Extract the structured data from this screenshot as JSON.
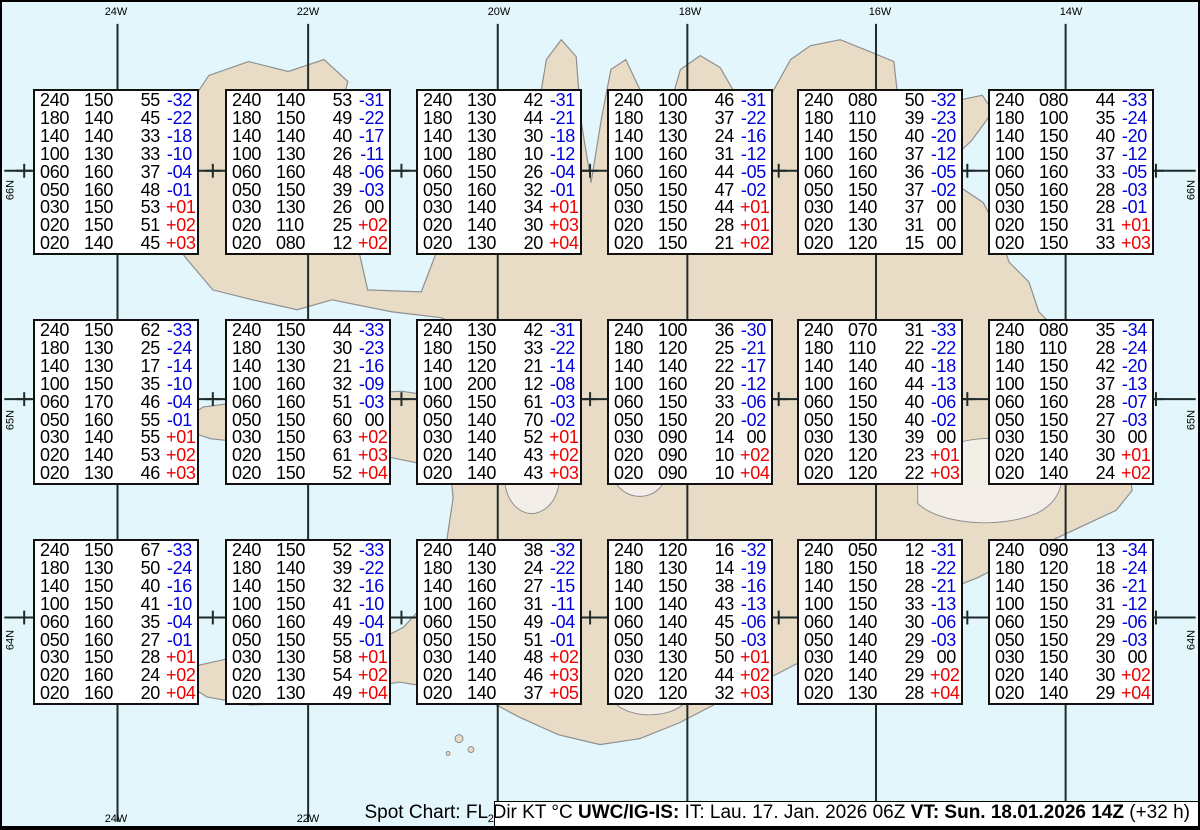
{
  "colors": {
    "sea": "#e2f6fb",
    "land": "#e9dcc6",
    "coast": "#8f8f8f",
    "grid": "#1f2a2a",
    "negative_temp": "#0000dd",
    "positive_temp": "#ee0000",
    "zero_temp": "#000000",
    "box_bg": "#ffffff",
    "box_border": "#111111"
  },
  "map": {
    "meridians": [
      {
        "label": "24W",
        "x": 114
      },
      {
        "label": "22W",
        "x": 306
      },
      {
        "label": "20W",
        "x": 497
      },
      {
        "label": "18W",
        "x": 688
      },
      {
        "label": "16W",
        "x": 878
      },
      {
        "label": "14W",
        "x": 1069
      }
    ],
    "parallels": [
      {
        "label": "66N",
        "y": 170
      },
      {
        "label": "65N",
        "y": 400
      },
      {
        "label": "64N",
        "y": 620
      }
    ],
    "cross_xs": [
      20,
      210,
      400,
      590,
      780,
      970,
      1160
    ]
  },
  "legend": {
    "segments": [
      {
        "text": "Spot Chart: FL Dir KT °C ",
        "bold": false
      },
      {
        "text": "UWC/IG-IS:",
        "bold": true
      },
      {
        "text": " IT: Lau. 17. Jan. 2026 06Z ",
        "bold": false
      },
      {
        "text": "VT: Sun. 18.01.2026 14Z",
        "bold": true
      },
      {
        "text": " (+32 h)",
        "bold": false
      }
    ]
  },
  "chart_data": {
    "type": "table",
    "title": "Spot Chart: FL Dir KT °C",
    "columns": [
      "FL",
      "Dir",
      "KT",
      "°C"
    ],
    "producer": "UWC/IG-IS",
    "issued": "IT: Lau. 17. Jan. 2026 06Z",
    "valid": "VT: Sun. 18.01.2026 14Z",
    "forecast_offset": "(+32 h)",
    "grid_longitudes": [
      "24W",
      "22W",
      "20W",
      "18W",
      "16W",
      "14W"
    ],
    "grid_latitudes": [
      "66N",
      "65N",
      "64N"
    ],
    "spots": [
      {
        "lon": "24W",
        "lat": "66N",
        "rows": [
          [
            "240",
            "150",
            "55",
            "-32"
          ],
          [
            "180",
            "140",
            "45",
            "-22"
          ],
          [
            "140",
            "140",
            "33",
            "-18"
          ],
          [
            "100",
            "130",
            "33",
            "-10"
          ],
          [
            "060",
            "160",
            "37",
            "-04"
          ],
          [
            "050",
            "160",
            "48",
            "-01"
          ],
          [
            "030",
            "150",
            "53",
            "+01"
          ],
          [
            "020",
            "150",
            "51",
            "+02"
          ],
          [
            "020",
            "140",
            "45",
            "+03"
          ]
        ]
      },
      {
        "lon": "22W",
        "lat": "66N",
        "rows": [
          [
            "240",
            "140",
            "53",
            "-31"
          ],
          [
            "180",
            "150",
            "49",
            "-22"
          ],
          [
            "140",
            "140",
            "40",
            "-17"
          ],
          [
            "100",
            "130",
            "26",
            "-11"
          ],
          [
            "060",
            "160",
            "48",
            "-06"
          ],
          [
            "050",
            "150",
            "39",
            "-03"
          ],
          [
            "030",
            "130",
            "26",
            "00"
          ],
          [
            "020",
            "110",
            "25",
            "+02"
          ],
          [
            "020",
            "080",
            "12",
            "+02"
          ]
        ]
      },
      {
        "lon": "20W",
        "lat": "66N",
        "rows": [
          [
            "240",
            "130",
            "42",
            "-31"
          ],
          [
            "180",
            "130",
            "44",
            "-21"
          ],
          [
            "140",
            "130",
            "30",
            "-18"
          ],
          [
            "100",
            "180",
            "10",
            "-12"
          ],
          [
            "060",
            "150",
            "26",
            "-04"
          ],
          [
            "050",
            "160",
            "32",
            "-01"
          ],
          [
            "030",
            "140",
            "34",
            "+01"
          ],
          [
            "020",
            "140",
            "30",
            "+03"
          ],
          [
            "020",
            "130",
            "20",
            "+04"
          ]
        ]
      },
      {
        "lon": "18W",
        "lat": "66N",
        "rows": [
          [
            "240",
            "100",
            "46",
            "-31"
          ],
          [
            "180",
            "130",
            "37",
            "-22"
          ],
          [
            "140",
            "130",
            "24",
            "-16"
          ],
          [
            "100",
            "160",
            "31",
            "-12"
          ],
          [
            "060",
            "160",
            "44",
            "-05"
          ],
          [
            "050",
            "150",
            "47",
            "-02"
          ],
          [
            "030",
            "150",
            "44",
            "+01"
          ],
          [
            "020",
            "150",
            "28",
            "+01"
          ],
          [
            "020",
            "150",
            "21",
            "+02"
          ]
        ]
      },
      {
        "lon": "16W",
        "lat": "66N",
        "rows": [
          [
            "240",
            "080",
            "50",
            "-32"
          ],
          [
            "180",
            "110",
            "39",
            "-23"
          ],
          [
            "140",
            "150",
            "40",
            "-20"
          ],
          [
            "100",
            "160",
            "37",
            "-12"
          ],
          [
            "060",
            "160",
            "36",
            "-05"
          ],
          [
            "050",
            "150",
            "37",
            "-02"
          ],
          [
            "030",
            "140",
            "37",
            "00"
          ],
          [
            "020",
            "130",
            "31",
            "00"
          ],
          [
            "020",
            "120",
            "15",
            "00"
          ]
        ]
      },
      {
        "lon": "14W",
        "lat": "66N",
        "rows": [
          [
            "240",
            "080",
            "44",
            "-33"
          ],
          [
            "180",
            "100",
            "35",
            "-24"
          ],
          [
            "140",
            "150",
            "40",
            "-20"
          ],
          [
            "100",
            "150",
            "37",
            "-12"
          ],
          [
            "060",
            "160",
            "33",
            "-05"
          ],
          [
            "050",
            "160",
            "28",
            "-03"
          ],
          [
            "030",
            "150",
            "28",
            "-01"
          ],
          [
            "020",
            "150",
            "31",
            "+01"
          ],
          [
            "020",
            "150",
            "33",
            "+03"
          ]
        ]
      },
      {
        "lon": "24W",
        "lat": "65N",
        "rows": [
          [
            "240",
            "150",
            "62",
            "-33"
          ],
          [
            "180",
            "130",
            "25",
            "-24"
          ],
          [
            "140",
            "130",
            "17",
            "-14"
          ],
          [
            "100",
            "150",
            "35",
            "-10"
          ],
          [
            "060",
            "170",
            "46",
            "-04"
          ],
          [
            "050",
            "160",
            "55",
            "-01"
          ],
          [
            "030",
            "140",
            "55",
            "+01"
          ],
          [
            "020",
            "140",
            "53",
            "+02"
          ],
          [
            "020",
            "130",
            "46",
            "+03"
          ]
        ]
      },
      {
        "lon": "22W",
        "lat": "65N",
        "rows": [
          [
            "240",
            "150",
            "44",
            "-33"
          ],
          [
            "180",
            "130",
            "30",
            "-23"
          ],
          [
            "140",
            "130",
            "21",
            "-16"
          ],
          [
            "100",
            "160",
            "32",
            "-09"
          ],
          [
            "060",
            "160",
            "51",
            "-03"
          ],
          [
            "050",
            "150",
            "60",
            "00"
          ],
          [
            "030",
            "150",
            "63",
            "+02"
          ],
          [
            "020",
            "150",
            "61",
            "+03"
          ],
          [
            "020",
            "150",
            "52",
            "+04"
          ]
        ]
      },
      {
        "lon": "20W",
        "lat": "65N",
        "rows": [
          [
            "240",
            "130",
            "42",
            "-31"
          ],
          [
            "180",
            "150",
            "33",
            "-22"
          ],
          [
            "140",
            "120",
            "21",
            "-14"
          ],
          [
            "100",
            "200",
            "12",
            "-08"
          ],
          [
            "060",
            "150",
            "61",
            "-03"
          ],
          [
            "050",
            "140",
            "70",
            "-02"
          ],
          [
            "030",
            "140",
            "52",
            "+01"
          ],
          [
            "020",
            "140",
            "43",
            "+02"
          ],
          [
            "020",
            "140",
            "43",
            "+03"
          ]
        ]
      },
      {
        "lon": "18W",
        "lat": "65N",
        "rows": [
          [
            "240",
            "100",
            "36",
            "-30"
          ],
          [
            "180",
            "120",
            "25",
            "-21"
          ],
          [
            "140",
            "140",
            "22",
            "-17"
          ],
          [
            "100",
            "160",
            "20",
            "-12"
          ],
          [
            "060",
            "150",
            "33",
            "-06"
          ],
          [
            "050",
            "150",
            "20",
            "-02"
          ],
          [
            "030",
            "090",
            "14",
            "00"
          ],
          [
            "020",
            "090",
            "10",
            "+02"
          ],
          [
            "020",
            "090",
            "10",
            "+04"
          ]
        ]
      },
      {
        "lon": "16W",
        "lat": "65N",
        "rows": [
          [
            "240",
            "070",
            "31",
            "-33"
          ],
          [
            "180",
            "110",
            "22",
            "-22"
          ],
          [
            "140",
            "140",
            "40",
            "-18"
          ],
          [
            "100",
            "160",
            "44",
            "-13"
          ],
          [
            "060",
            "150",
            "40",
            "-06"
          ],
          [
            "050",
            "150",
            "40",
            "-02"
          ],
          [
            "030",
            "130",
            "39",
            "00"
          ],
          [
            "020",
            "120",
            "23",
            "+01"
          ],
          [
            "020",
            "120",
            "22",
            "+03"
          ]
        ]
      },
      {
        "lon": "14W",
        "lat": "65N",
        "rows": [
          [
            "240",
            "080",
            "35",
            "-34"
          ],
          [
            "180",
            "110",
            "28",
            "-24"
          ],
          [
            "140",
            "150",
            "42",
            "-20"
          ],
          [
            "100",
            "150",
            "37",
            "-13"
          ],
          [
            "060",
            "160",
            "28",
            "-07"
          ],
          [
            "050",
            "150",
            "27",
            "-03"
          ],
          [
            "030",
            "150",
            "30",
            "00"
          ],
          [
            "020",
            "140",
            "30",
            "+01"
          ],
          [
            "020",
            "140",
            "24",
            "+02"
          ]
        ]
      },
      {
        "lon": "24W",
        "lat": "64N",
        "rows": [
          [
            "240",
            "150",
            "67",
            "-33"
          ],
          [
            "180",
            "130",
            "50",
            "-24"
          ],
          [
            "140",
            "150",
            "40",
            "-16"
          ],
          [
            "100",
            "150",
            "41",
            "-10"
          ],
          [
            "060",
            "160",
            "35",
            "-04"
          ],
          [
            "050",
            "160",
            "27",
            "-01"
          ],
          [
            "030",
            "150",
            "28",
            "+01"
          ],
          [
            "020",
            "160",
            "24",
            "+02"
          ],
          [
            "020",
            "160",
            "20",
            "+04"
          ]
        ]
      },
      {
        "lon": "22W",
        "lat": "64N",
        "rows": [
          [
            "240",
            "150",
            "52",
            "-33"
          ],
          [
            "180",
            "140",
            "39",
            "-22"
          ],
          [
            "140",
            "150",
            "32",
            "-16"
          ],
          [
            "100",
            "150",
            "41",
            "-10"
          ],
          [
            "060",
            "160",
            "49",
            "-04"
          ],
          [
            "050",
            "150",
            "55",
            "-01"
          ],
          [
            "030",
            "130",
            "58",
            "+01"
          ],
          [
            "020",
            "130",
            "54",
            "+02"
          ],
          [
            "020",
            "130",
            "49",
            "+04"
          ]
        ]
      },
      {
        "lon": "20W",
        "lat": "64N",
        "rows": [
          [
            "240",
            "140",
            "38",
            "-32"
          ],
          [
            "180",
            "130",
            "24",
            "-22"
          ],
          [
            "140",
            "160",
            "27",
            "-15"
          ],
          [
            "100",
            "160",
            "31",
            "-11"
          ],
          [
            "060",
            "150",
            "49",
            "-04"
          ],
          [
            "050",
            "150",
            "51",
            "-01"
          ],
          [
            "030",
            "140",
            "48",
            "+02"
          ],
          [
            "020",
            "140",
            "46",
            "+03"
          ],
          [
            "020",
            "140",
            "37",
            "+05"
          ]
        ]
      },
      {
        "lon": "18W",
        "lat": "64N",
        "rows": [
          [
            "240",
            "120",
            "16",
            "-32"
          ],
          [
            "180",
            "130",
            "14",
            "-19"
          ],
          [
            "140",
            "150",
            "38",
            "-16"
          ],
          [
            "100",
            "140",
            "43",
            "-13"
          ],
          [
            "060",
            "140",
            "45",
            "-06"
          ],
          [
            "050",
            "140",
            "50",
            "-03"
          ],
          [
            "030",
            "130",
            "50",
            "+01"
          ],
          [
            "020",
            "120",
            "44",
            "+02"
          ],
          [
            "020",
            "120",
            "32",
            "+03"
          ]
        ]
      },
      {
        "lon": "16W",
        "lat": "64N",
        "rows": [
          [
            "240",
            "050",
            "12",
            "-31"
          ],
          [
            "180",
            "150",
            "18",
            "-22"
          ],
          [
            "140",
            "150",
            "28",
            "-21"
          ],
          [
            "100",
            "150",
            "33",
            "-13"
          ],
          [
            "060",
            "140",
            "30",
            "-06"
          ],
          [
            "050",
            "140",
            "29",
            "-03"
          ],
          [
            "030",
            "140",
            "29",
            "00"
          ],
          [
            "020",
            "140",
            "29",
            "+02"
          ],
          [
            "020",
            "130",
            "28",
            "+04"
          ]
        ]
      },
      {
        "lon": "14W",
        "lat": "64N",
        "rows": [
          [
            "240",
            "090",
            "13",
            "-34"
          ],
          [
            "180",
            "120",
            "18",
            "-24"
          ],
          [
            "140",
            "150",
            "36",
            "-21"
          ],
          [
            "100",
            "150",
            "31",
            "-12"
          ],
          [
            "060",
            "150",
            "29",
            "-06"
          ],
          [
            "050",
            "150",
            "29",
            "-03"
          ],
          [
            "030",
            "150",
            "30",
            "00"
          ],
          [
            "020",
            "140",
            "30",
            "+02"
          ],
          [
            "020",
            "140",
            "29",
            "+04"
          ]
        ]
      }
    ]
  }
}
